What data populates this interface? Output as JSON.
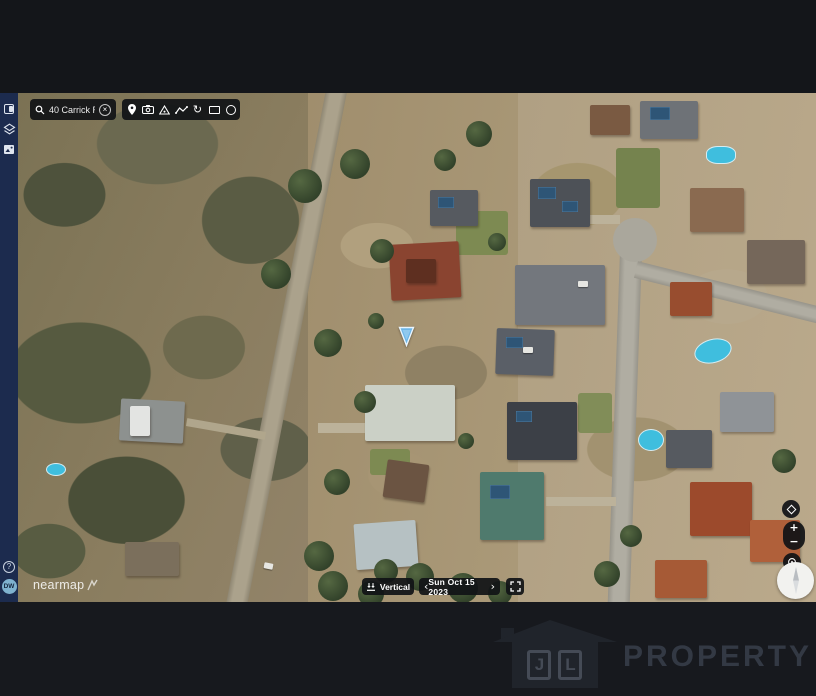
{
  "search": {
    "value": "40 Carrick Rd, ...",
    "clear_glyph": "×"
  },
  "toolbar": {
    "rotate_glyph": "↻",
    "tools": [
      "location-marker",
      "camera",
      "survey-point",
      "line-measure",
      "rotate-view",
      "rectangle-measure",
      "circle-measure"
    ]
  },
  "sidebar": {
    "help_glyph": "?",
    "avatar_initials": "DW"
  },
  "map": {
    "watermark": "nearmap"
  },
  "controls": {
    "view_label": "Vertical",
    "date_label": "Sun Oct 15 2023",
    "prev_glyph": "‹",
    "next_glyph": "›",
    "zoom_in_glyph": "+",
    "zoom_out_glyph": "−"
  },
  "branding": {
    "initial_j": "J",
    "initial_l": "L",
    "name": "PROPERTY"
  },
  "colors": {
    "sidebar_bg": "#1c2b4e",
    "control_bg": "#15171c",
    "marker_blue": "#6db6e8",
    "avatar_bg": "#7fb2cf",
    "logo_grey": "#333944",
    "pool_blue": "#3fbede"
  }
}
